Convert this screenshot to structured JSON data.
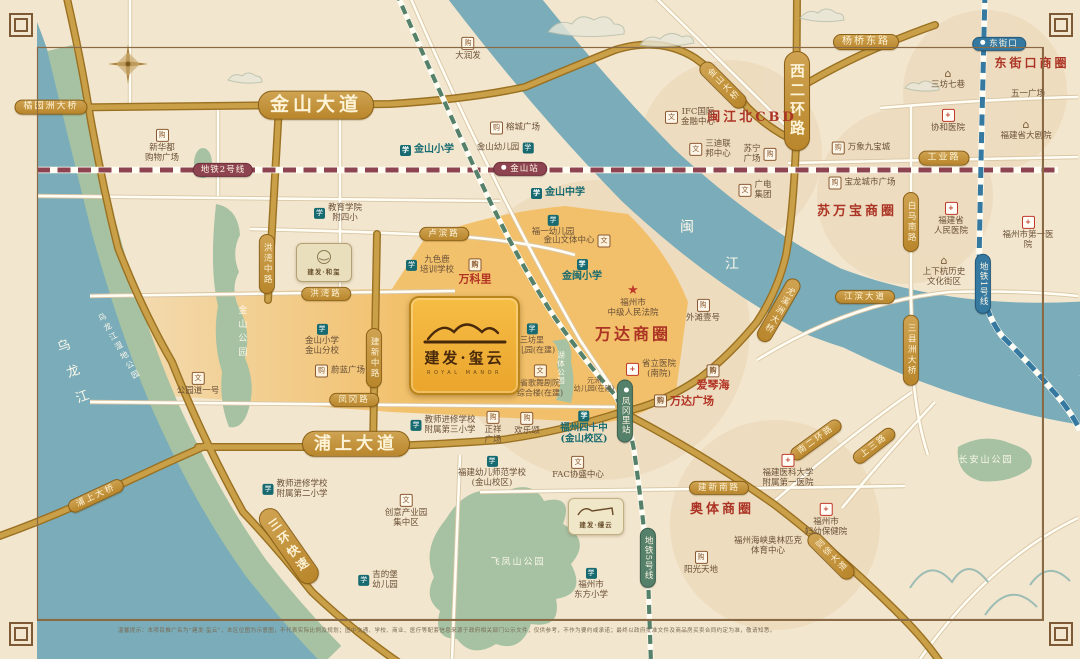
{
  "meta": {
    "title": "建发·玺云 区位示意图",
    "disclaimer": "温馨提示：本项目推广名为“建发·玺云”，本区位图为示意图，不代表实际比例及规划；图中交通、学校、商业、医疗等配套信息来源于政府相关部门公示文件，仅供参考，不作为要约或承诺；最终以政府批准文件及商品房买卖合同约定为准，敬请知悉。"
  },
  "brand": {
    "main_name": "建发·玺云",
    "main_latin": "ROYAL MANOR",
    "hexi_name": "建发·和玺",
    "manyun_name": "建发·缦云"
  },
  "colors": {
    "gold_road": "#c99f48",
    "river": "#7aacb9",
    "park_green": "#a6c2a3",
    "zone_orange": "#f2bc60",
    "metro_line1": "#3579a1",
    "metro_line2": "#8e4450",
    "metro_line5": "#55806a",
    "accent_red": "#ac3425",
    "school_teal": "#166a70",
    "pill_gold": "#c1903a"
  },
  "map": {
    "road_pills": [
      {
        "t": "橘园洲大桥",
        "x": 51,
        "y": 107,
        "fs": 9
      },
      {
        "t": "金山大道",
        "x": 316,
        "y": 105,
        "fs": 19,
        "big": 1
      },
      {
        "t": "金山大桥",
        "x": 723,
        "y": 85,
        "v": 1,
        "r": -45,
        "fs": 8.5
      },
      {
        "t": "杨桥东路",
        "x": 866,
        "y": 42,
        "fs": 10
      },
      {
        "t": "西二环路",
        "x": 797,
        "y": 101,
        "v": 1,
        "fs": 15,
        "big": 1
      },
      {
        "t": "工业路",
        "x": 944,
        "y": 158,
        "fs": 9
      },
      {
        "t": "白马南路",
        "x": 911,
        "y": 222,
        "v": 1,
        "fs": 8.5
      },
      {
        "t": "三县洲大桥",
        "x": 911,
        "y": 350,
        "v": 1,
        "fs": 8.5
      },
      {
        "t": "尤溪洲大桥",
        "x": 779,
        "y": 310,
        "v": 1,
        "r": 30,
        "fs": 8.5
      },
      {
        "t": "江滨大道",
        "x": 865,
        "y": 297,
        "fs": 8.5
      },
      {
        "t": "洪湾中路",
        "x": 267,
        "y": 264,
        "v": 1,
        "fs": 8.5
      },
      {
        "t": "卢滨路",
        "x": 444,
        "y": 234,
        "fs": 8.5
      },
      {
        "t": "洪湾路",
        "x": 326,
        "y": 294,
        "fs": 8.5
      },
      {
        "t": "建新中路",
        "x": 374,
        "y": 358,
        "v": 1,
        "fs": 8.5
      },
      {
        "t": "凤冈路",
        "x": 354,
        "y": 400,
        "fs": 8.5
      },
      {
        "t": "浦上大道",
        "x": 356,
        "y": 444,
        "fs": 17,
        "big": 1
      },
      {
        "t": "三环快速",
        "x": 289,
        "y": 546,
        "v": 1,
        "r": -35,
        "fs": 12,
        "big": 1
      },
      {
        "t": "浦上大桥",
        "x": 96,
        "y": 496,
        "r": -25,
        "fs": 8.5
      },
      {
        "t": "建新南路",
        "x": 719,
        "y": 488,
        "fs": 8.5
      },
      {
        "t": "南二环路",
        "x": 816,
        "y": 440,
        "r": -36,
        "fs": 8.5
      },
      {
        "t": "上三路",
        "x": 874,
        "y": 446,
        "r": -38,
        "fs": 8.5
      },
      {
        "t": "则徐大道",
        "x": 831,
        "y": 556,
        "v": 1,
        "r": -45,
        "fs": 8.5
      }
    ],
    "metro_labels": [
      {
        "t": "地铁2号线",
        "x": 223,
        "y": 170,
        "line": "m2"
      },
      {
        "t": "地铁5号线",
        "x": 648,
        "y": 558,
        "v": 1,
        "line": "m5"
      },
      {
        "t": "地铁1号线",
        "x": 983,
        "y": 284,
        "v": 1,
        "line": "m1"
      }
    ],
    "stations": [
      {
        "t": "金山站",
        "x": 520,
        "y": 169,
        "line": "m2"
      },
      {
        "t": "凤冈里站",
        "x": 625,
        "y": 411,
        "v": 1,
        "line": "m5"
      },
      {
        "t": "东街口",
        "x": 999,
        "y": 44,
        "line": "m1"
      }
    ],
    "areas": [
      {
        "t": "万达商圈",
        "x": 633,
        "y": 334,
        "fs": 16
      },
      {
        "t": "闽江北CBD",
        "x": 752,
        "y": 118,
        "fs": 13
      },
      {
        "t": "苏万宝商圈",
        "x": 857,
        "y": 212,
        "fs": 13
      },
      {
        "t": "东街口商圈",
        "x": 1032,
        "y": 63,
        "fs": 12
      },
      {
        "t": "奥体商圈",
        "x": 722,
        "y": 510,
        "fs": 13
      }
    ],
    "parks": [
      {
        "t": "乌龙江",
        "x": 73,
        "y": 378,
        "v": 1,
        "r": -20,
        "fs": 13,
        "ls": 14
      },
      {
        "t": "乌龙江湿地公园",
        "x": 119,
        "y": 347,
        "v": 1,
        "r": -30,
        "fs": 8,
        "ls": 3
      },
      {
        "t": "金山公园",
        "x": 241,
        "y": 333,
        "v": 1,
        "fs": 9,
        "ls": 5
      },
      {
        "t": "湖体公园",
        "x": 561,
        "y": 368,
        "v": 1,
        "fs": 7.5,
        "ls": 1
      },
      {
        "t": "飞凤山公园",
        "x": 518,
        "y": 563,
        "fs": 9,
        "ls": 2
      },
      {
        "t": "长安山公园",
        "x": 986,
        "y": 461,
        "fs": 9,
        "ls": 2
      },
      {
        "t": "闽",
        "x": 688,
        "y": 228,
        "fs": 14
      },
      {
        "t": "江",
        "x": 733,
        "y": 265,
        "fs": 14
      }
    ],
    "pois": [
      {
        "t": "新华都\n购物广场",
        "x": 162,
        "y": 146,
        "ic": "shop",
        "ip": "top"
      },
      {
        "t": "大润发",
        "x": 468,
        "y": 49,
        "ic": "shop",
        "ip": "top"
      },
      {
        "t": "榕城广场",
        "x": 515,
        "y": 128,
        "ic": "shop",
        "ip": "left"
      },
      {
        "t": "金山幼儿园",
        "x": 505,
        "y": 148,
        "ic": "school",
        "ip": "right"
      },
      {
        "t": "金山小学",
        "x": 427,
        "y": 150,
        "ic": "school",
        "ip": "left",
        "c": "teal",
        "fs": 10
      },
      {
        "t": "金山中学",
        "x": 558,
        "y": 193,
        "ic": "school",
        "ip": "left",
        "c": "teal",
        "fs": 10
      },
      {
        "t": "福一幼儿园",
        "x": 553,
        "y": 226,
        "ic": "school",
        "ip": "top"
      },
      {
        "t": "金山文体中心",
        "x": 577,
        "y": 241,
        "ic": "culture",
        "ip": "right"
      },
      {
        "t": "教育学院\n附四小",
        "x": 338,
        "y": 213,
        "ic": "school",
        "ip": "left"
      },
      {
        "t": "九色鹿\n培训学校",
        "x": 430,
        "y": 265,
        "ic": "school",
        "ip": "left"
      },
      {
        "t": "万科里",
        "x": 475,
        "y": 272,
        "ic": "shop",
        "ip": "top",
        "c": "red",
        "fs": 11
      },
      {
        "t": "金闽小学",
        "x": 582,
        "y": 271,
        "ic": "school",
        "ip": "top",
        "c": "teal",
        "fs": 10
      },
      {
        "t": "福州市\n中级人民法院",
        "x": 633,
        "y": 301,
        "ic": "star",
        "ip": "top"
      },
      {
        "t": "外滩壹号",
        "x": 703,
        "y": 311,
        "ic": "shop",
        "ip": "top"
      },
      {
        "t": "三坊里\n幼儿园(在建)",
        "x": 532,
        "y": 339,
        "ic": "school",
        "ip": "top",
        "fs": 8
      },
      {
        "t": "省歌舞剧院\n综合楼(在建)",
        "x": 540,
        "y": 381,
        "ic": "culture",
        "ip": "top",
        "fs": 8
      },
      {
        "t": "元洲\n幼儿园(在建)",
        "x": 594,
        "y": 385,
        "fs": 7
      },
      {
        "t": "省立医院\n(南院)",
        "x": 651,
        "y": 369,
        "ic": "hospital",
        "ip": "left"
      },
      {
        "t": "爱琴海",
        "x": 713,
        "y": 378,
        "ic": "shop",
        "ip": "top",
        "c": "red",
        "fs": 11
      },
      {
        "t": "万达广场",
        "x": 684,
        "y": 401,
        "ic": "shop",
        "ip": "left",
        "c": "red",
        "fs": 11
      },
      {
        "t": "福州四十中\n(金山校区)",
        "x": 584,
        "y": 428,
        "ic": "school",
        "ip": "top",
        "c": "teal",
        "fs": 9.5
      },
      {
        "t": "FAC协盛中心",
        "x": 578,
        "y": 468,
        "ic": "culture",
        "ip": "top"
      },
      {
        "t": "正祥\n广场",
        "x": 493,
        "y": 428,
        "ic": "shop",
        "ip": "top"
      },
      {
        "t": "欢乐颂",
        "x": 527,
        "y": 424,
        "ic": "shop",
        "ip": "top"
      },
      {
        "t": "教师进修学校\n附属第三小学",
        "x": 443,
        "y": 425,
        "ic": "school",
        "ip": "left"
      },
      {
        "t": "福建幼儿师范学校\n(金山校区)",
        "x": 492,
        "y": 472,
        "ic": "school",
        "ip": "top"
      },
      {
        "t": "教师进修学校\n附属第二小学",
        "x": 295,
        "y": 489,
        "ic": "school",
        "ip": "left"
      },
      {
        "t": "创意产业园\n集中区",
        "x": 406,
        "y": 511,
        "ic": "culture",
        "ip": "top"
      },
      {
        "t": "吉的堡\n幼儿园",
        "x": 378,
        "y": 580,
        "ic": "school",
        "ip": "left"
      },
      {
        "t": "福州市\n东方小学",
        "x": 591,
        "y": 584,
        "ic": "school",
        "ip": "top"
      },
      {
        "t": "阳光天地",
        "x": 701,
        "y": 563,
        "ic": "shop",
        "ip": "top"
      },
      {
        "t": "福建医科大学\n附属第一医院",
        "x": 788,
        "y": 471,
        "ic": "hospital",
        "ip": "top"
      },
      {
        "t": "福州市\n妇幼保健院",
        "x": 826,
        "y": 520,
        "ic": "hospital",
        "ip": "top"
      },
      {
        "t": "福州海峡奥林匹克\n体育中心",
        "x": 768,
        "y": 546
      },
      {
        "t": "公园道一号",
        "x": 198,
        "y": 384,
        "ic": "culture",
        "ip": "top"
      },
      {
        "t": "金山小学\n金山分校",
        "x": 322,
        "y": 340,
        "ic": "school",
        "ip": "top"
      },
      {
        "t": "蔚蓝广场",
        "x": 340,
        "y": 371,
        "ic": "shop",
        "ip": "left"
      },
      {
        "t": "IFC国际\n金融中心",
        "x": 690,
        "y": 117,
        "ic": "culture",
        "ip": "left"
      },
      {
        "t": "三迪联\n邦中心",
        "x": 710,
        "y": 149,
        "ic": "culture",
        "ip": "left"
      },
      {
        "t": "广电\n集团",
        "x": 755,
        "y": 190,
        "ic": "culture",
        "ip": "left"
      },
      {
        "t": "苏宁\n广场",
        "x": 760,
        "y": 154,
        "ic": "shop",
        "ip": "right"
      },
      {
        "t": "万象九宝城",
        "x": 861,
        "y": 148,
        "ic": "shop",
        "ip": "left"
      },
      {
        "t": "宝龙城市广场",
        "x": 862,
        "y": 183,
        "ic": "shop",
        "ip": "left"
      },
      {
        "t": "三坊七巷",
        "x": 948,
        "y": 79,
        "ic": "roof",
        "ip": "top"
      },
      {
        "t": "协和医院",
        "x": 948,
        "y": 121,
        "ic": "hospital",
        "ip": "top"
      },
      {
        "t": "五一广场",
        "x": 1028,
        "y": 94
      },
      {
        "t": "福建省大剧院",
        "x": 1026,
        "y": 130,
        "ic": "roof",
        "ip": "top"
      },
      {
        "t": "福建省\n人民医院",
        "x": 951,
        "y": 219,
        "ic": "hospital",
        "ip": "top"
      },
      {
        "t": "福州市第一医院",
        "x": 1028,
        "y": 233,
        "ic": "hospital",
        "ip": "top"
      },
      {
        "t": "上下杭历史\n文化街区",
        "x": 944,
        "y": 271,
        "ic": "roof",
        "ip": "top"
      }
    ]
  }
}
